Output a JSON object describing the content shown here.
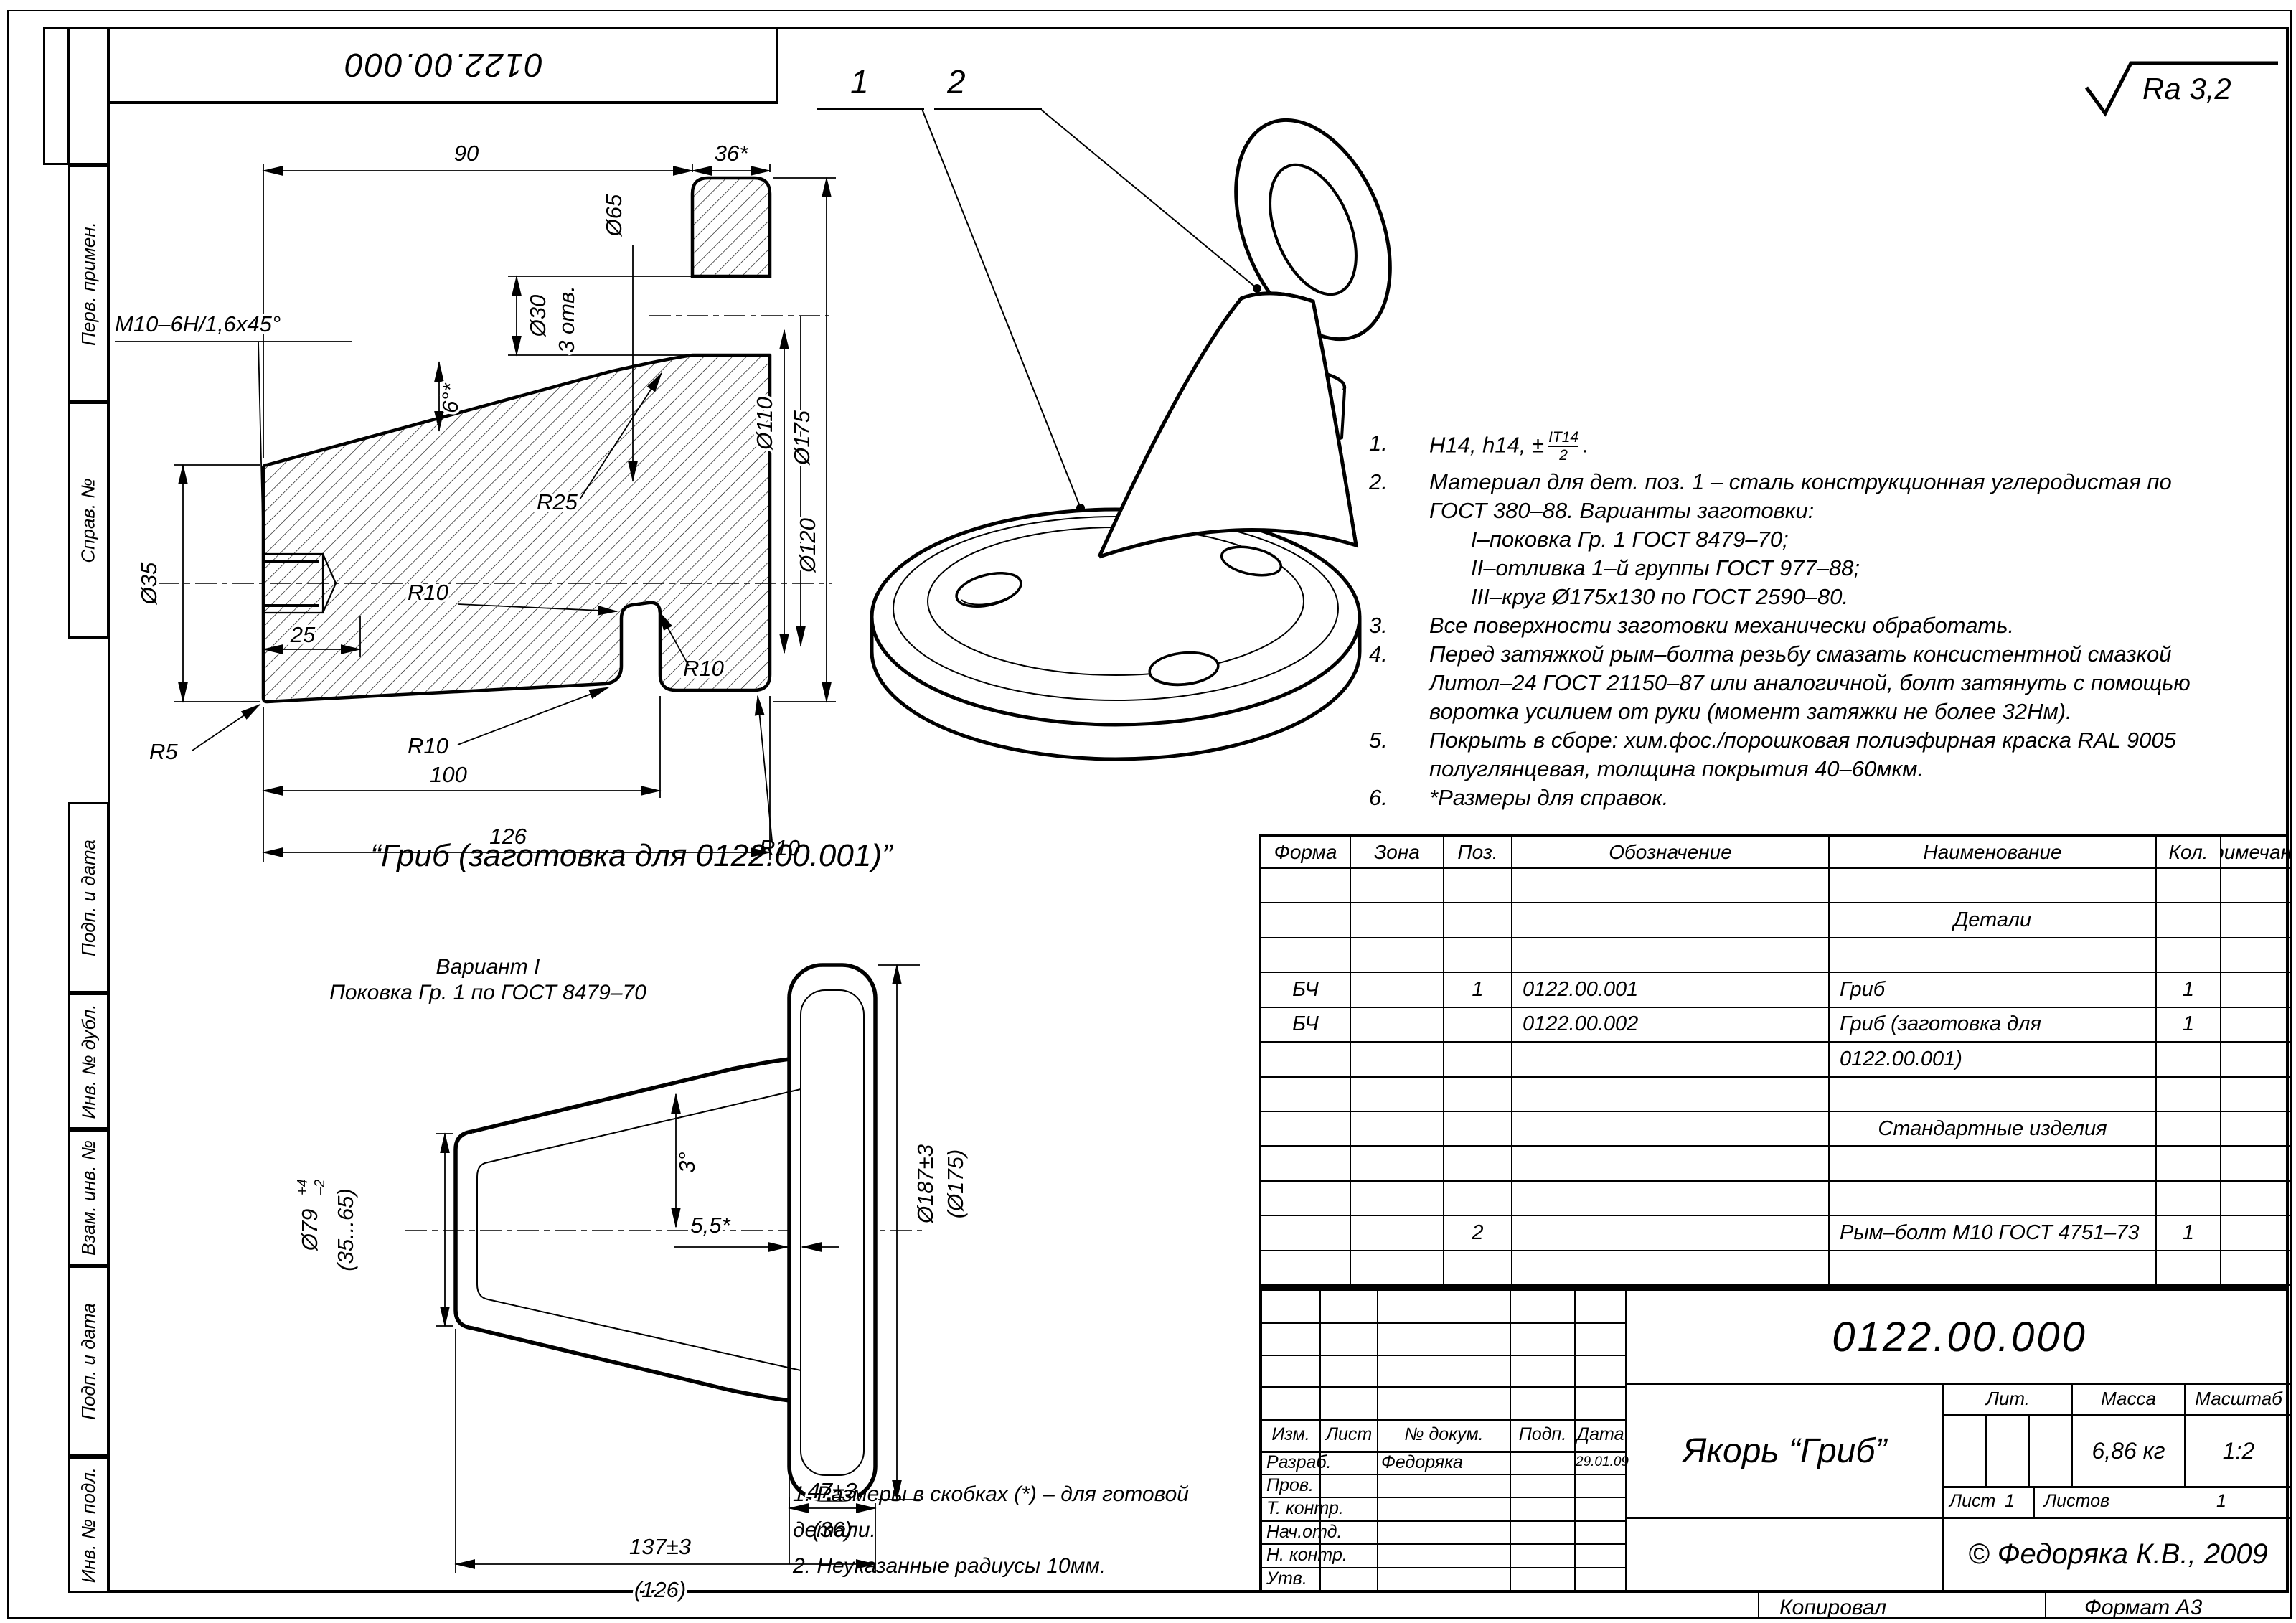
{
  "sheet": {
    "stamp": "0122.00.000",
    "surface_finish": "Ra 3,2",
    "copied_label": "Копировал",
    "format_label": "Формат А3"
  },
  "margin_labels": [
    "Перв. примен.",
    "Справ. №",
    "Подп. и дата",
    "Инв. № дубл.",
    "Взам. инв. №",
    "Подп. и дата",
    "Инв. № подл."
  ],
  "main_view": {
    "d90": "90",
    "d36": "36*",
    "d30": "Ø30",
    "d30n": "3 отв.",
    "thread": "M10–6H/1,6х45°",
    "d35": "Ø35",
    "r5": "R5",
    "d25": "25",
    "angle": "6°*",
    "d65": "Ø65",
    "r25": "R25",
    "d110": "Ø110",
    "d120": "Ø120",
    "d175": "Ø175",
    "r10": "R10",
    "d100": "100",
    "d126": "126"
  },
  "iso_view": {
    "callout1": "1",
    "callout2": "2"
  },
  "notes": {
    "n1": {
      "num": "1.",
      "pre": "H14, h14, ±",
      "frac_top": "IT14",
      "frac_bot": "2",
      "post": "."
    },
    "n2": {
      "num": "2.",
      "l1": "Материал для дет. поз. 1 – сталь конструкционная углеродистая по",
      "l2": "ГОСТ 380–88. Варианты заготовки:",
      "s1": "I–поковка Гр. 1 ГОСТ 8479–70;",
      "s2": "II–отливка 1–й группы ГОСТ 977–88;",
      "s3": "III–круг Ø175х130 по ГОСТ 2590–80."
    },
    "n3": {
      "num": "3.",
      "l1": "Все поверхности заготовки механически обработать."
    },
    "n4": {
      "num": "4.",
      "l1": "Перед затяжкой рым–болта резьбу смазать консистентной смазкой",
      "l2": "Литол–24 ГОСТ 21150–87 или аналогичной, болт затянуть с помощью",
      "l3": "воротка усилием от руки (момент затяжки не более 32Нм)."
    },
    "n5": {
      "num": "5.",
      "l1": "Покрыть в сборе: хим.фос./порошковая полиэфирная краска RAL 9005",
      "l2": "полуглянцевая, толщина покрытия 40–60мкм."
    },
    "n6": {
      "num": "6.",
      "l1": "*Размеры для справок."
    }
  },
  "blank_view": {
    "subtitle": "“Гриб (заготовка для 0122.00.001)”",
    "variant1": "Вариант I",
    "variant2": "Поковка Гр. 1 по ГОСТ 8479–70",
    "d79": "Ø79",
    "d79p": "+4",
    "d79m": "–2",
    "d79ref": "(35...65)",
    "a3": "3°",
    "d55": "5,5*",
    "d187": "Ø187±3",
    "d175ref": "(Ø175)",
    "d47": "47±3",
    "d36ref": "(36)",
    "d137": "137±3",
    "d126ref": "(126)",
    "note1": "1. Размеры в скобках (*) – для готовой детали.",
    "note2": "2. Неуказанные радиусы 10мм."
  },
  "spec_table": {
    "headers": [
      "Форма",
      "Зона",
      "Поз.",
      "Обозначение",
      "Наименование",
      "Кол.",
      "Примечание"
    ],
    "rows": [
      {
        "c": [
          "",
          "",
          "",
          "",
          "",
          "",
          ""
        ]
      },
      {
        "c": [
          "",
          "",
          "",
          "",
          "Детали",
          "",
          ""
        ],
        "center": true
      },
      {
        "c": [
          "",
          "",
          "",
          "",
          "",
          "",
          ""
        ]
      },
      {
        "c": [
          "БЧ",
          "",
          "1",
          "0122.00.001",
          "Гриб",
          "1",
          ""
        ]
      },
      {
        "c": [
          "БЧ",
          "",
          "",
          "0122.00.002",
          "Гриб (заготовка для",
          "1",
          ""
        ]
      },
      {
        "c": [
          "",
          "",
          "",
          "",
          "0122.00.001)",
          "",
          ""
        ]
      },
      {
        "c": [
          "",
          "",
          "",
          "",
          "",
          "",
          ""
        ]
      },
      {
        "c": [
          "",
          "",
          "",
          "",
          "Стандартные изделия",
          "",
          ""
        ],
        "center": true
      },
      {
        "c": [
          "",
          "",
          "",
          "",
          "",
          "",
          ""
        ]
      },
      {
        "c": [
          "",
          "",
          "",
          "",
          "",
          "",
          ""
        ]
      },
      {
        "c": [
          "",
          "",
          "2",
          "",
          "Рым–болт М10 ГОСТ 4751–73",
          "1",
          ""
        ]
      },
      {
        "c": [
          "",
          "",
          "",
          "",
          "",
          "",
          ""
        ]
      }
    ]
  },
  "title_block": {
    "doc_number": "0122.00.000",
    "title": "Якорь “Гриб”",
    "col_izm": "Изм.",
    "col_list": "Лист",
    "col_doc": "№ докум.",
    "col_podp": "Подп.",
    "col_data": "Дата",
    "lit_label": "Лит.",
    "mass_label": "Масса",
    "scale_label": "Масштаб",
    "mass_value": "6,86 кг",
    "scale_value": "1:2",
    "sheet_label": "Лист",
    "sheet_value": "1",
    "sheets_label": "Листов",
    "sheets_value": "1",
    "rows": [
      {
        "label": "Разраб.",
        "name": "Федоряка",
        "date": "29.01.09"
      },
      {
        "label": "Пров.",
        "name": "",
        "date": ""
      },
      {
        "label": "Т. контр.",
        "name": "",
        "date": ""
      },
      {
        "label": "Нач.отд.",
        "name": "",
        "date": ""
      },
      {
        "label": "Н. контр.",
        "name": "",
        "date": ""
      },
      {
        "label": "Утв.",
        "name": "",
        "date": ""
      }
    ],
    "copyright": "© Федоряка К.В., 2009"
  }
}
